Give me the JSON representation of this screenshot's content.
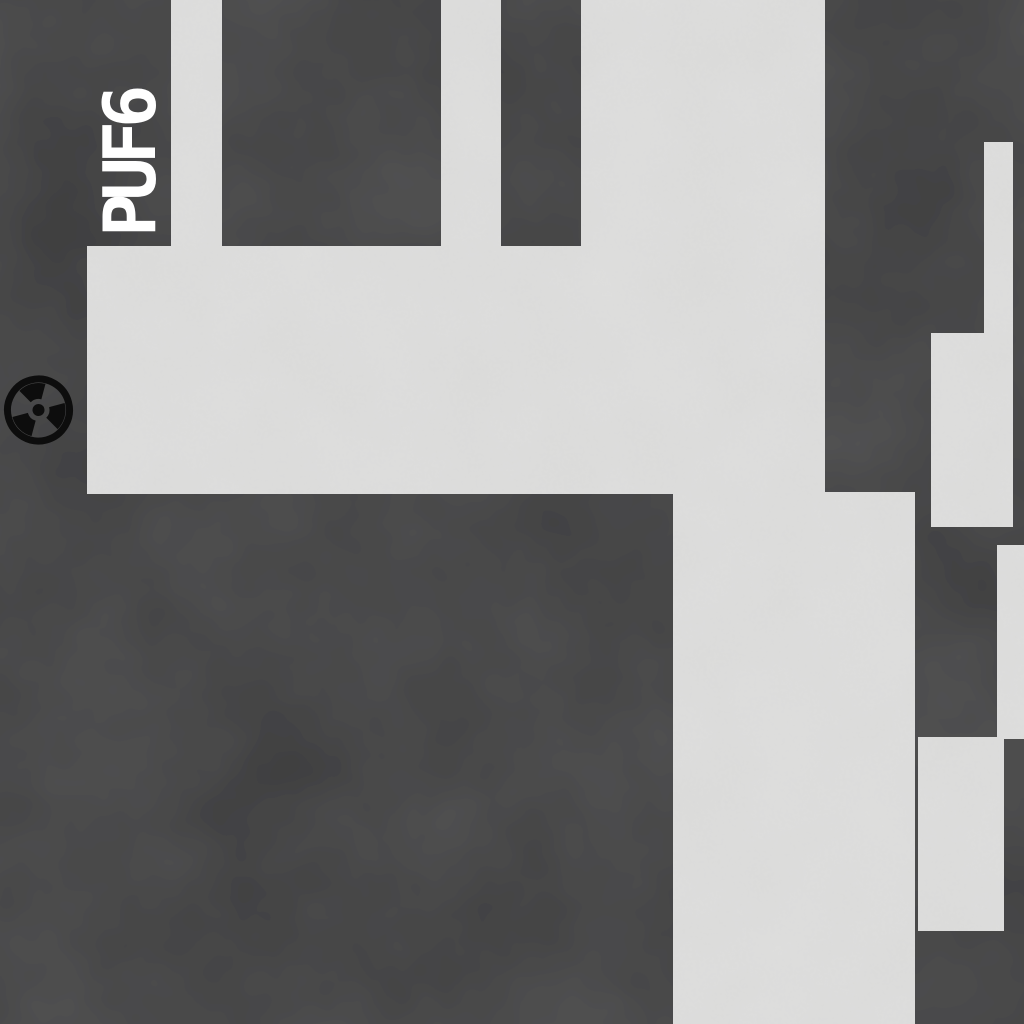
{
  "map": {
    "room_label": "PUF6",
    "marker": {
      "icon": "radiation-icon"
    }
  },
  "colors": {
    "background": "#3c3c3d",
    "floor": "#dbdbda",
    "label_text": "#ffffff",
    "marker_icon": "#0d0d0d"
  }
}
